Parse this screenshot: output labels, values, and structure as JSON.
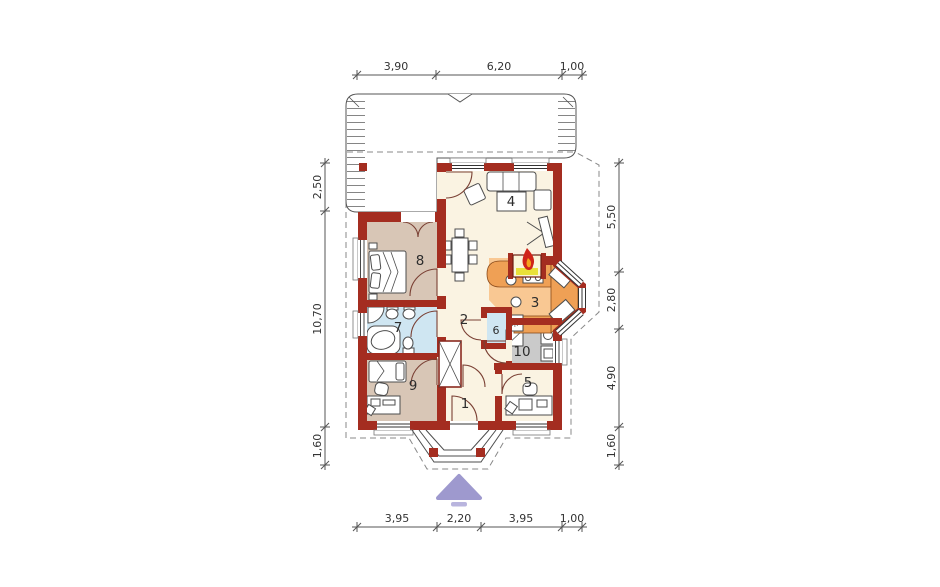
{
  "dimensions": {
    "top": [
      "3,90",
      "6,20",
      "1,00"
    ],
    "bottom": [
      "3,95",
      "2,20",
      "3,95",
      "1,00"
    ],
    "left": [
      "2,50",
      "10,70",
      "1,60"
    ],
    "right": [
      "5,50",
      "2,80",
      "4,90",
      "1,60"
    ]
  },
  "room_numbers": [
    "1",
    "2",
    "3",
    "4",
    "5",
    "6",
    "7",
    "8",
    "9",
    "10"
  ],
  "icons": {
    "asterisk": "✳"
  },
  "colors": {
    "wall": "#a42d20",
    "floor_cream": "#faf3e2",
    "floor_bedroom": "#d8c6b6",
    "floor_bath": "#cfe6f2",
    "floor_kitchen": "#f9c893",
    "kitchen_counter": "#efa055",
    "floor_utility": "#cacaca",
    "terrace": "#ffffff",
    "flame": "#cf2418",
    "entrance_arrow": "#9e99ce",
    "entrance_arrow_bar": "#b9b5de",
    "dashed_outline": "#888888"
  }
}
